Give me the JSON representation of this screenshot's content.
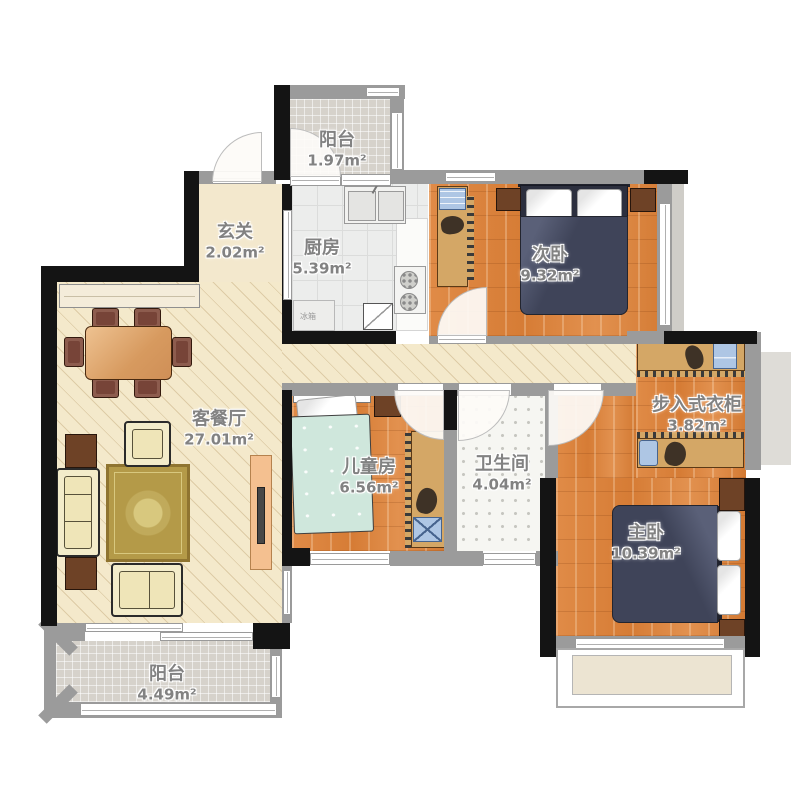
{
  "plan": {
    "type": "apartment-floor-plan",
    "rooms": [
      {
        "id": "balcony-top",
        "name": "阳台",
        "area": "1.97m²"
      },
      {
        "id": "entry",
        "name": "玄关",
        "area": "2.02m²"
      },
      {
        "id": "kitchen",
        "name": "厨房",
        "area": "5.39m²"
      },
      {
        "id": "bedroom-second",
        "name": "次卧",
        "area": "9.32m²"
      },
      {
        "id": "living-dining",
        "name": "客餐厅",
        "area": "27.01m²"
      },
      {
        "id": "kids-room",
        "name": "儿童房",
        "area": "6.56m²"
      },
      {
        "id": "bathroom",
        "name": "卫生间",
        "area": "4.04m²"
      },
      {
        "id": "walk-in-closet",
        "name": "步入式衣柜",
        "area": "3.82m²"
      },
      {
        "id": "bedroom-master",
        "name": "主卧",
        "area": "10.39m²"
      },
      {
        "id": "balcony-bottom",
        "name": "阳台",
        "area": "4.49m²"
      }
    ],
    "fridge_label": "冰箱",
    "colors": {
      "wall_black": "#141414",
      "wall_gray": "#9b9b9b",
      "wood_floor": "#dc8440",
      "living_floor": "#f4e9cb",
      "balcony_tile": "#d6d2cb",
      "kitchen_tile": "#ecedec",
      "bed_navy": "#3f4459",
      "kids_bed_teal": "#cfe7dc",
      "sofa_cream": "#f3ecca",
      "furniture_tan": "#d4a766",
      "nightstand_brown": "#6e4226",
      "rug_gold": "#b49a48",
      "label_gray": "#828282"
    }
  }
}
